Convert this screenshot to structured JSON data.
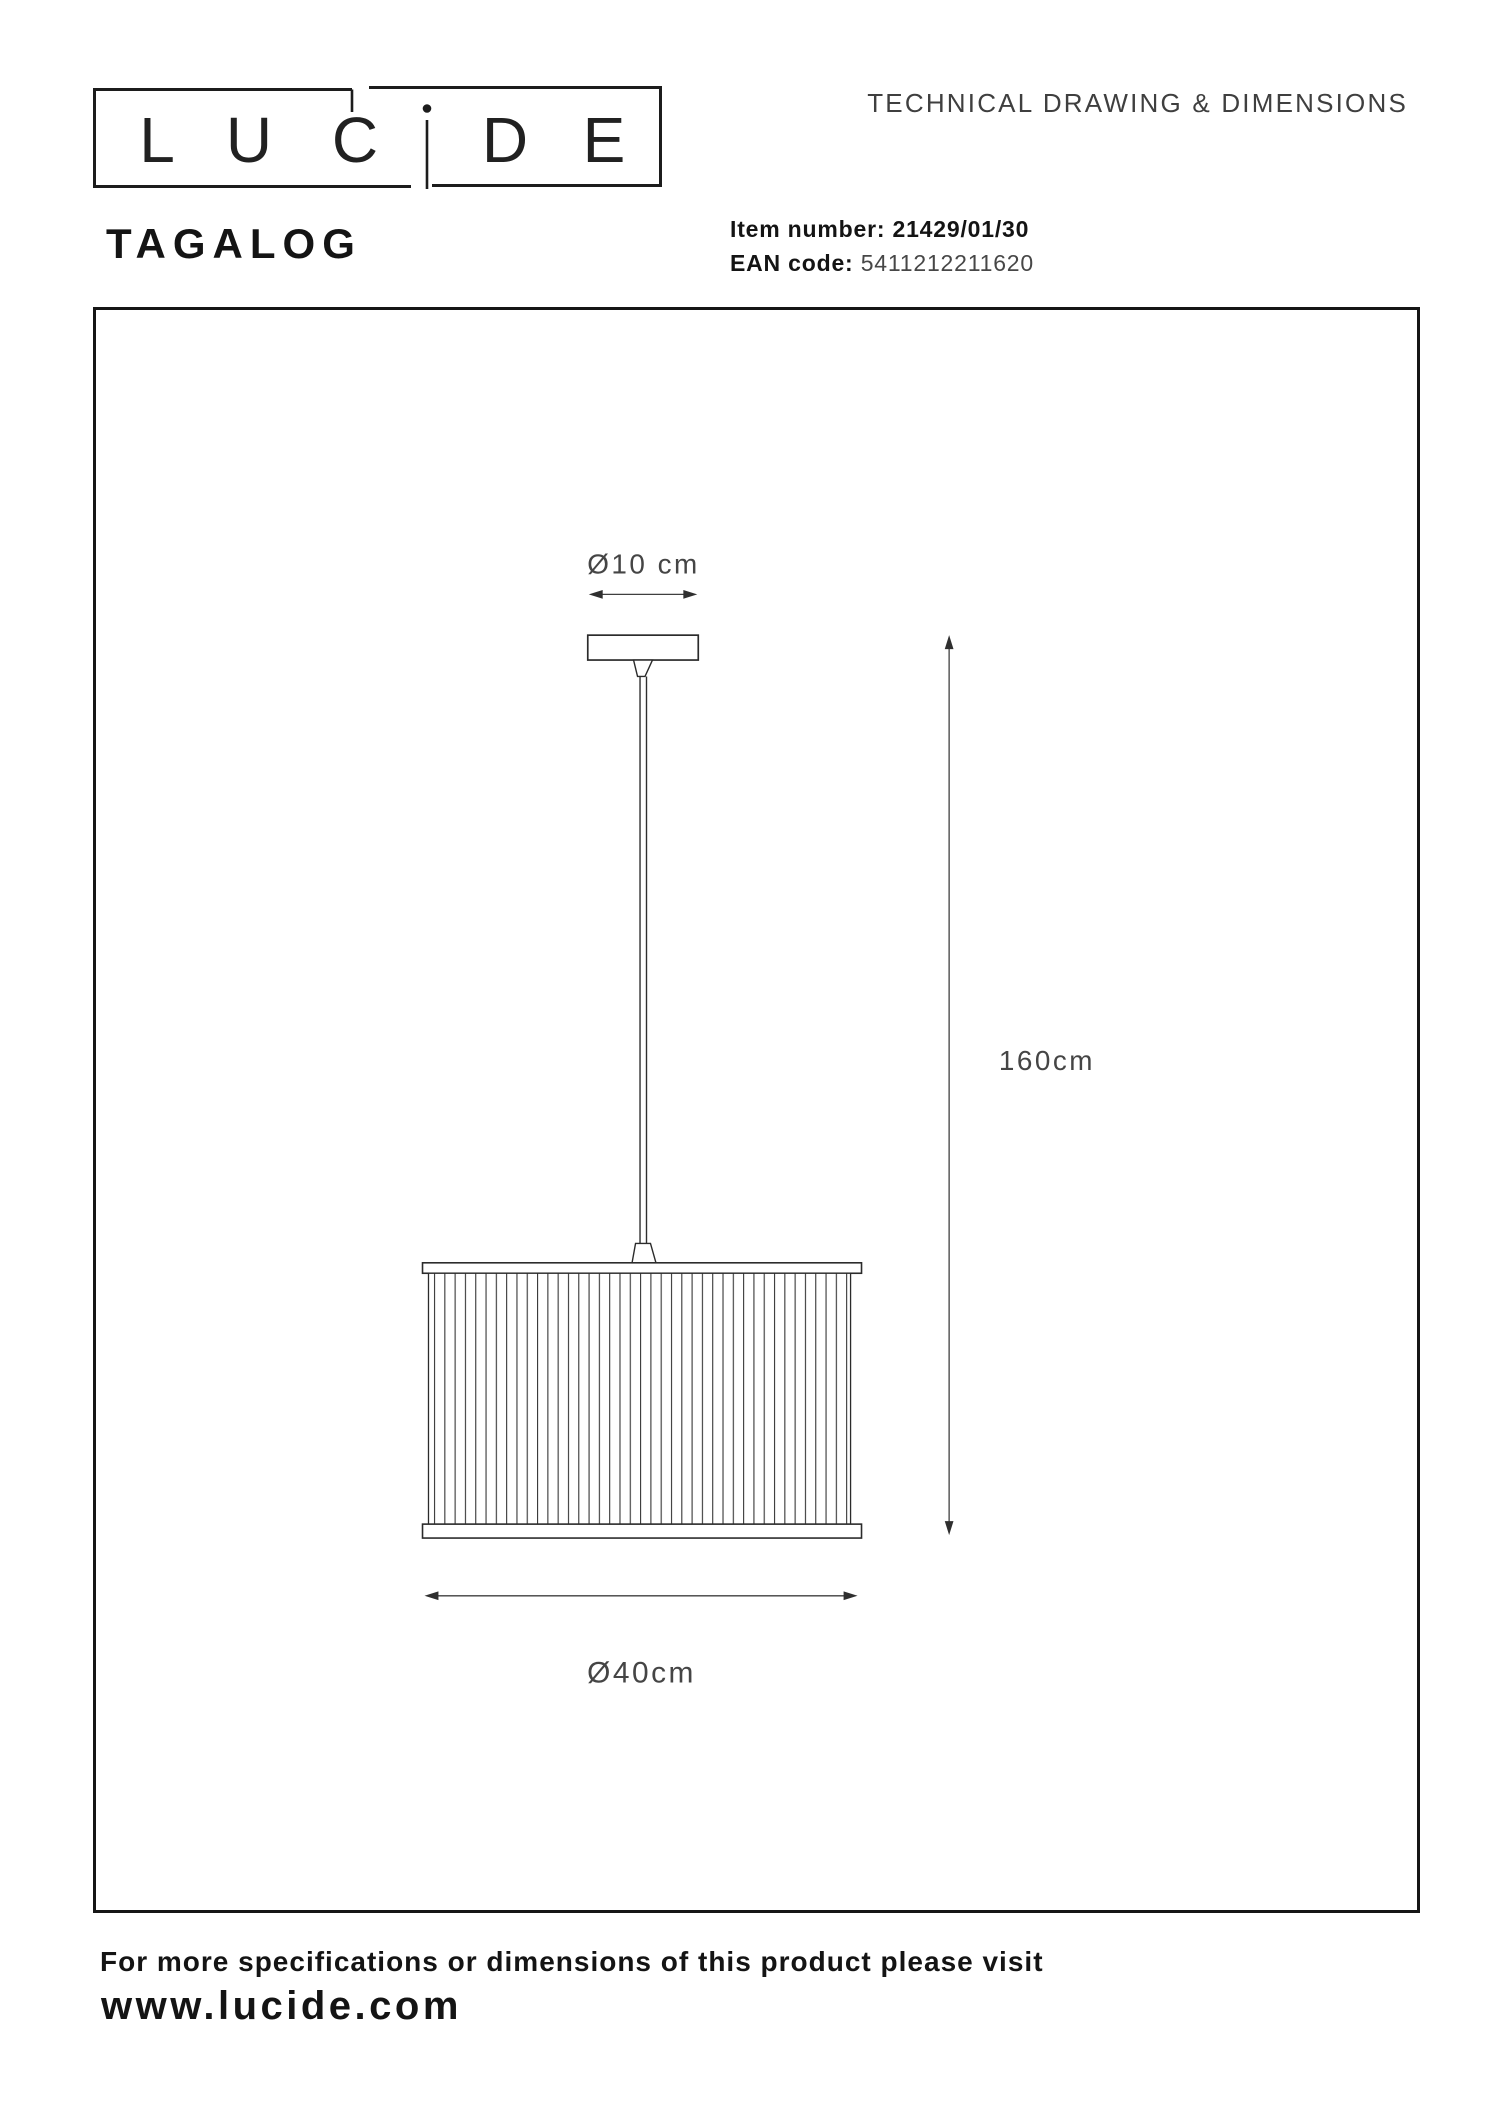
{
  "logo": {
    "letters": [
      "L",
      "U",
      "C",
      "i",
      "D",
      "E"
    ]
  },
  "header": {
    "title": "TECHNICAL DRAWING & DIMENSIONS"
  },
  "product": {
    "name": "TAGALOG",
    "item_label": "Item number:",
    "item_number": "21429/01/30",
    "ean_label": "EAN code:",
    "ean_code": "5411212211620"
  },
  "drawing": {
    "dim_top": "Ø10 cm",
    "dim_height": "160cm",
    "dim_bottom": "Ø40cm"
  },
  "footer": {
    "note": "For more specifications or dimensions of this product please visit",
    "website": "www.lucide.com"
  },
  "colors": {
    "ink": "#161616",
    "drawing_line": "#2b2b2b",
    "stripe_line": "#3a3a3a",
    "dimension_line": "#3f3f3f",
    "dimension_text": "#454545"
  }
}
